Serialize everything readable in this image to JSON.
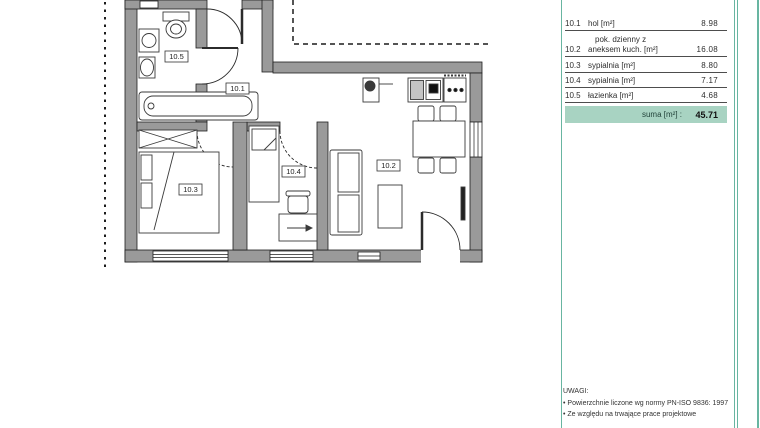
{
  "colors": {
    "accent_teal": "#68b5a1",
    "sum_background": "#a8d3c2",
    "wall_gray": "#9a9a9a"
  },
  "plan": {
    "room_labels": [
      {
        "id": "10.1"
      },
      {
        "id": "10.2"
      },
      {
        "id": "10.3"
      },
      {
        "id": "10.4"
      },
      {
        "id": "10.5"
      }
    ]
  },
  "area_table": {
    "rows": [
      {
        "no": "10.1",
        "name": "hol [m²]",
        "value": "8.98"
      },
      {
        "no": "10.2",
        "name_pre": "pok. dzienny z",
        "name": "aneksem kuch. [m²]",
        "value": "16.08"
      },
      {
        "no": "10.3",
        "name": "sypialnia [m²]",
        "value": "8.80"
      },
      {
        "no": "10.4",
        "name": "sypialnia [m²]",
        "value": "7.17"
      },
      {
        "no": "10.5",
        "name": "łazienka [m²]",
        "value": "4.68"
      }
    ],
    "sum_label": "suma [m²] :",
    "sum_value": "45.71"
  },
  "notes": {
    "title": "UWAGI:",
    "bullet1": "•  Powierzchnie liczone wg normy PN-ISO 9836: 1997",
    "bullet2": "•  Ze względu na trwające prace projektowe"
  }
}
